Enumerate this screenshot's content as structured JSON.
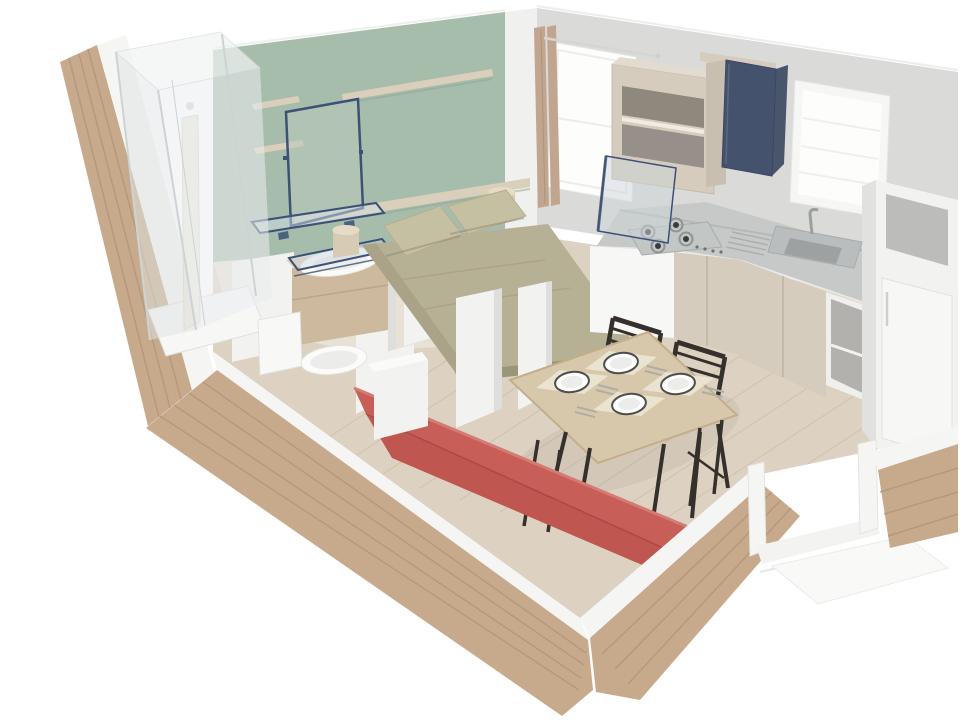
{
  "scene": {
    "kind": "3d-floorplan-cutaway-render",
    "subject": "studio mobile home interior: bedroom, bathroom, kitchen and living-dining area seen from above in cutaway perspective",
    "background": "#ffffff"
  },
  "colors": {
    "wall_green": "#a7bdac",
    "wall_gray": "#dadad8",
    "wall_trim": "#f0f0ee",
    "wood_tan": "#c7aa8b",
    "wood_plank_line": "#b29577",
    "rail_white": "#f5f5f3",
    "floor_wood": "#ddd2c1",
    "floor_line": "#c6b8a2",
    "floor_bedroom": "#e7e1d6",
    "glass_blue": "#3c5176",
    "shower_glass": "#e9edef",
    "bed_khaki": "#b6b094",
    "bed_shadow": "#a19b80",
    "pillow": "#c6c0a3",
    "shelf_wood": "#d9cfba",
    "vanity_tan": "#ccb99e",
    "vanity_top": "#e0d3bb",
    "partition_white": "#f2f2f0",
    "partition_side": "#dededc",
    "toilet_white": "#f8f8f6",
    "sofa_red": "#c75e57",
    "sofa_seat": "#bf564f",
    "sofa_dark": "#ab4b45",
    "sofa_highlight": "#d47c74",
    "table_wood": "#d8c8ab",
    "table_edge": "#c3ae8c",
    "chair_dark": "#35302c",
    "plate_rim": "#4e4e4e",
    "mat_cream": "#ece5d3",
    "counter_gray": "#c6c9c7",
    "steel": "#b9bdbd",
    "steel_dark": "#9aa0a0",
    "burner_dark": "#3b3d3d",
    "cabinet_wood": "#d5ccbd",
    "cabinet_shadow": "#8f887c",
    "navy_door": "#44526d",
    "fridge_white": "#f2f2f0",
    "fridge_side": "#e1e1df",
    "window_frame": "#f6f6f4",
    "window_glass": "#fdfdfc",
    "curtain_tan": "#c2a58e",
    "stool_wood": "#d8cbb4"
  },
  "inventory": {
    "bedroom": {
      "double_bed": 1,
      "pillows": 2,
      "wall_shelves": 3,
      "bedside_tables": 2,
      "mirror": 1
    },
    "bathroom": {
      "shower_cabin": 1,
      "toilet": 1,
      "washbasin_vanity": 1,
      "glass_shelf": 1
    },
    "kitchen": {
      "hob_burners": 4,
      "sink": 1,
      "windows": 2,
      "wall_cabinet_open_shelves": 2,
      "navy_wall_cabinet": 1,
      "fridge": 1,
      "base_cabinet_doors": 4
    },
    "dining": {
      "table": 1,
      "plates": 4,
      "placemats": 4,
      "chairs": 2
    },
    "living": {
      "sofa": 1
    },
    "exterior": {
      "plank_walls": 4,
      "door_opening": 1
    }
  }
}
